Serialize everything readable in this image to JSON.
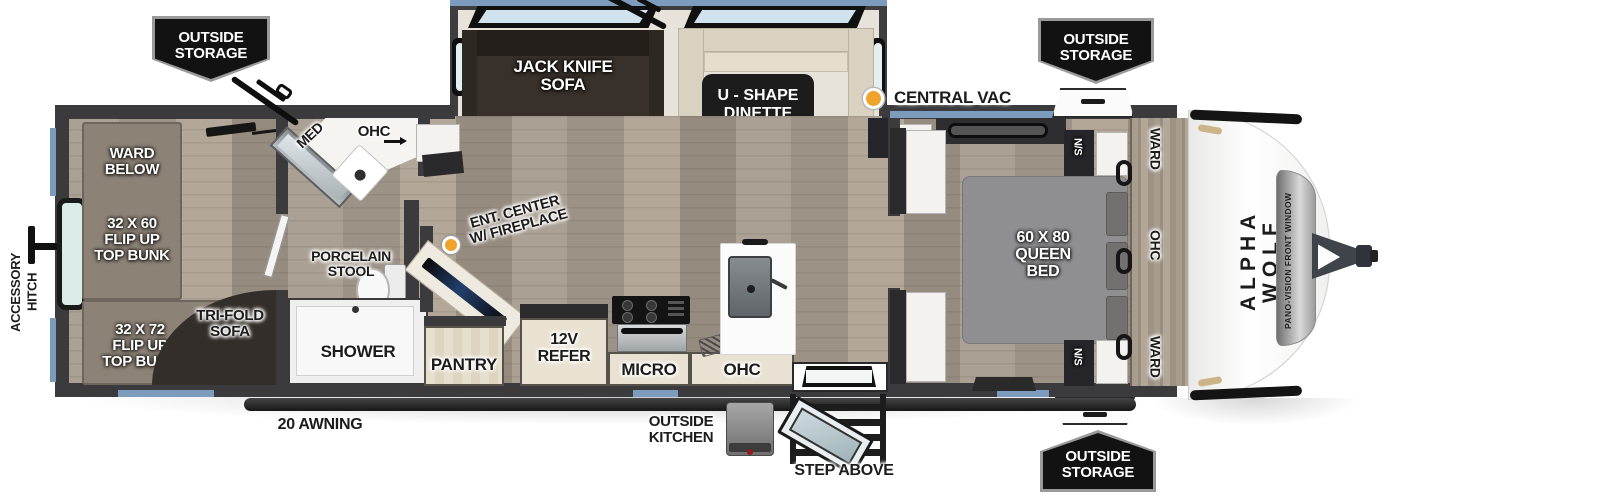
{
  "colors": {
    "wall": "#3b3b3d",
    "trim_blue": "#7d9cbd",
    "accent_orange": "#f0a32a",
    "tag_bg": "#121212",
    "floor": "#a89d90"
  },
  "tags": {
    "top_left": "OUTSIDE\nSTORAGE",
    "top_right": "OUTSIDE\nSTORAGE",
    "bottom_right": "OUTSIDE\nSTORAGE"
  },
  "exterior": {
    "accessory_hitch": "ACCESSORY\nHITCH",
    "central_vac": "CENTRAL VAC",
    "awning": "20 AWNING",
    "outside_kitchen": "OUTSIDE\nKITCHEN",
    "step_above": "STEP ABOVE"
  },
  "front_cap": {
    "brand": "ALPHA WOLF",
    "window": "PANO-VISION FRONT WINDOW"
  },
  "bunk_room": {
    "ward_below": "WARD\nBELOW",
    "bunk_top": "32 X 60\nFLIP UP\nTOP BUNK",
    "bunk_bottom": "32 X 72\nFLIP UP\nTOP BUNK",
    "trifold_sofa": "TRI-FOLD\nSOFA"
  },
  "bathroom": {
    "med": "MED",
    "ohc": "OHC",
    "stool": "PORCELAIN\nSTOOL",
    "shower": "SHOWER"
  },
  "living": {
    "sofa": "JACK KNIFE\nSOFA",
    "dinette": "U - SHAPE\nDINETTE",
    "ent_center": "ENT. CENTER\nW/ FIREPLACE"
  },
  "kitchen": {
    "pantry": "PANTRY",
    "refer": "12V\nREFER",
    "micro": "MICRO",
    "ohc": "OHC"
  },
  "bedroom": {
    "bed": "60 X 80\nQUEEN\nBED",
    "ns_top": "N/S",
    "ns_bottom": "N/S",
    "ward_top": "WARD",
    "ohc": "OHC",
    "ward_bottom": "WARD"
  }
}
